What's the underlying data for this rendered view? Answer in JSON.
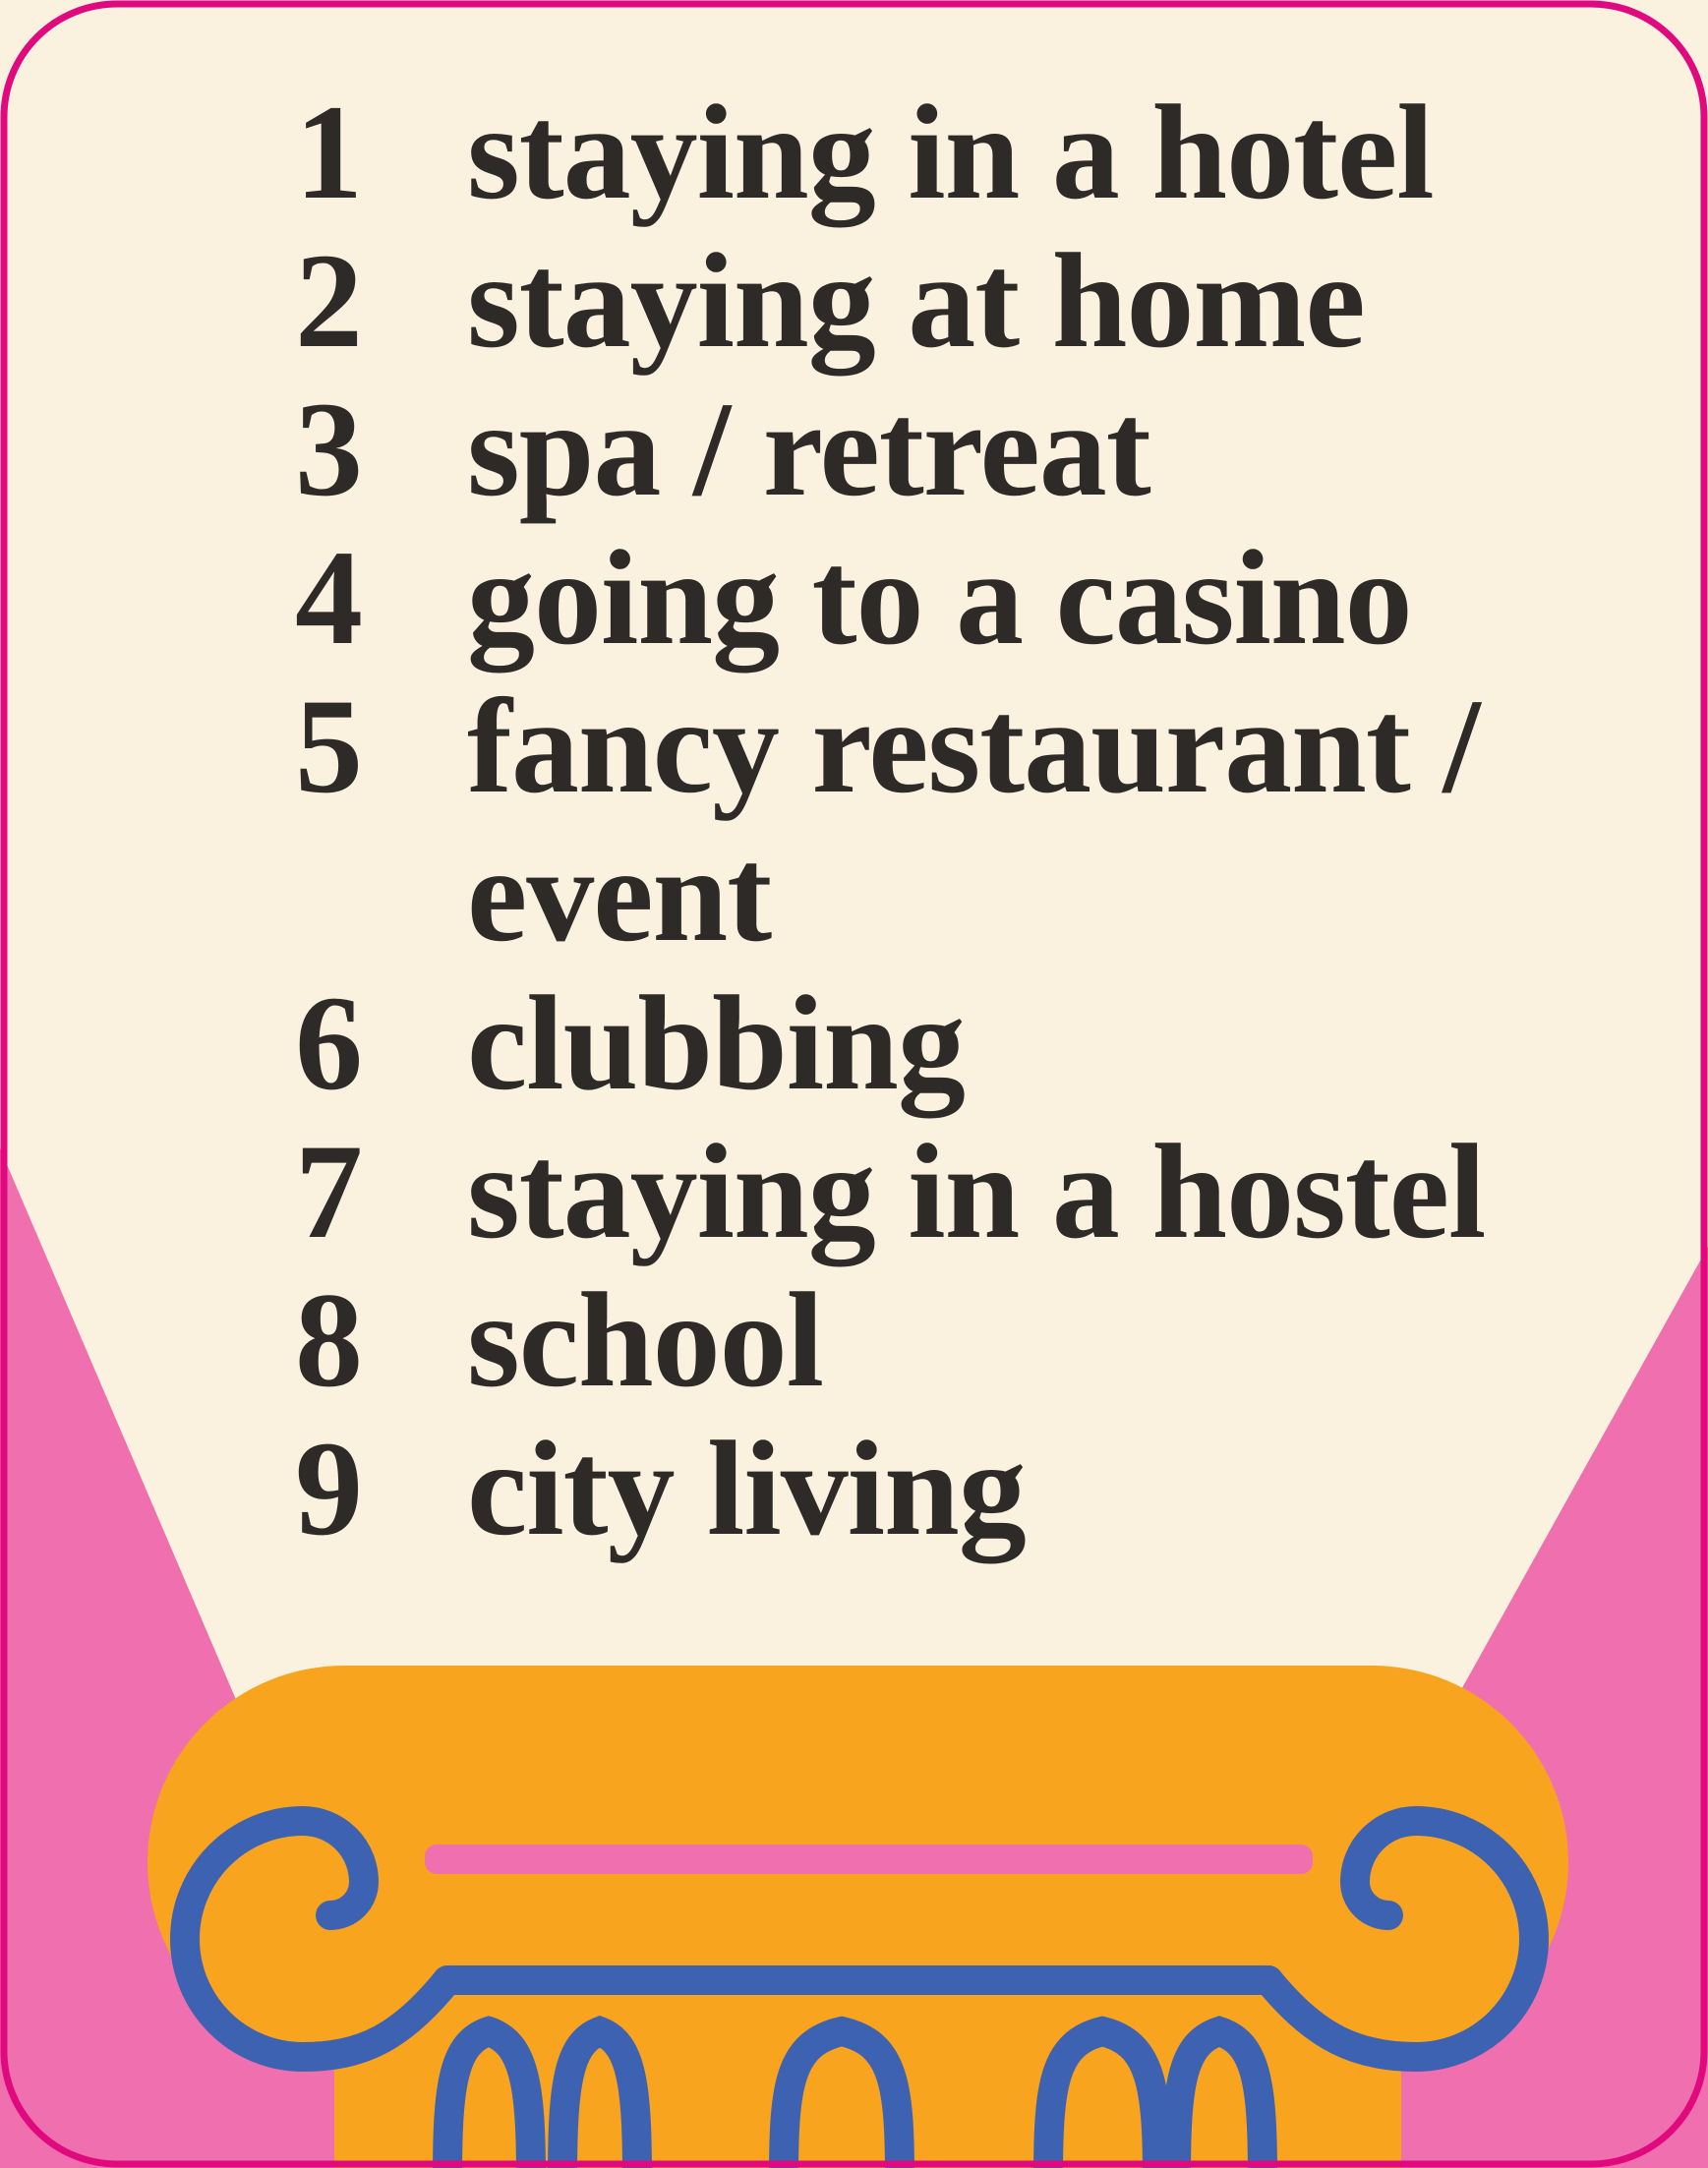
{
  "card": {
    "list": {
      "items": [
        {
          "num": "1",
          "label": "staying in a hotel"
        },
        {
          "num": "2",
          "label": "staying at home"
        },
        {
          "num": "3",
          "label": "spa / retreat"
        },
        {
          "num": "4",
          "label": "going to a casino"
        },
        {
          "num": "5",
          "label": "fancy restaurant /\nevent"
        },
        {
          "num": "6",
          "label": "clubbing"
        },
        {
          "num": "7",
          "label": "staying in a hostel"
        },
        {
          "num": "8",
          "label": "school"
        },
        {
          "num": "9",
          "label": "city living"
        }
      ]
    },
    "illustration": {
      "name": "classical-column-in-spotlight",
      "elements": [
        "pink-backdrop-left",
        "pink-backdrop-right",
        "column-shaft",
        "column-capital",
        "capital-pink-stripe",
        "capital-base-line",
        "volute-left-icon",
        "volute-right-icon",
        "flute-arches",
        "card-border"
      ]
    },
    "colors": {
      "cream": "#faf1de",
      "pink": "#f06fae",
      "magenta": "#e0097e",
      "orange": "#f8a41f",
      "blue": "#3e62b2",
      "ink": "#2e2a27"
    }
  }
}
